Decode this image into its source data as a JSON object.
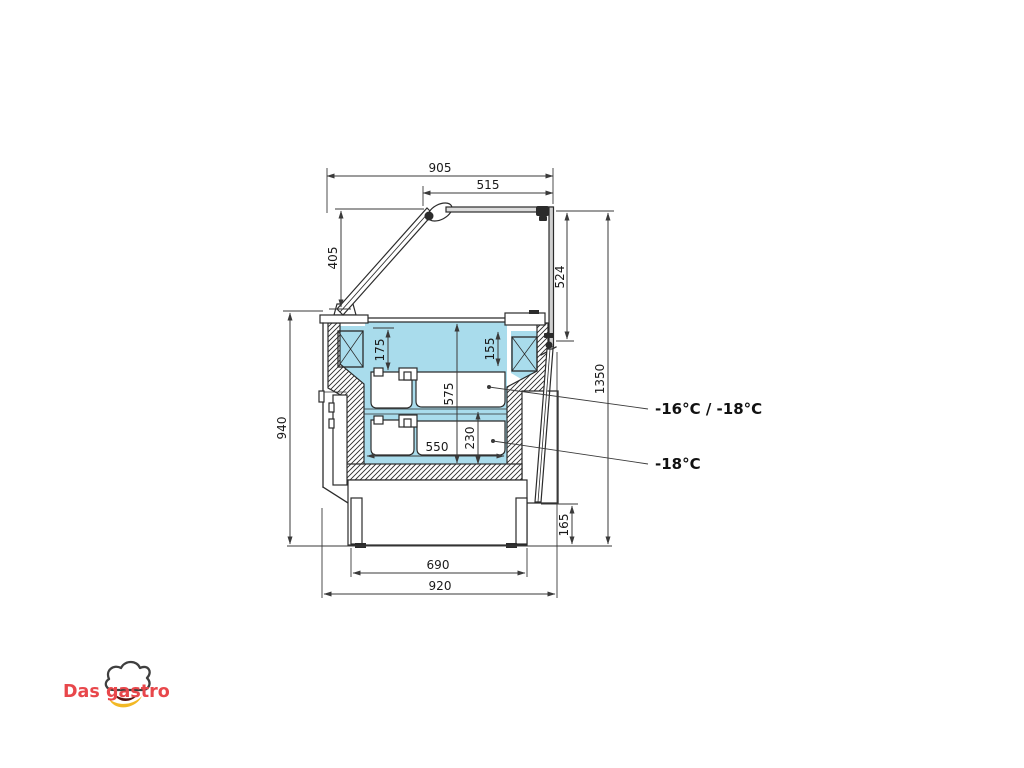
{
  "drawing": {
    "dimensions": {
      "top_width": "905",
      "top_inner_width": "515",
      "front_glass_height": "405",
      "rear_glass_height": "524",
      "total_height": "1350",
      "body_height": "940",
      "well_depth_left": "175",
      "well_depth_right": "155",
      "interior_depth": "575",
      "lower_interior_width": "550",
      "lower_tub_depth": "230",
      "base_width": "690",
      "overall_depth": "920",
      "base_height": "165"
    },
    "annotations": {
      "upper_temp": "-16°C / -18°C",
      "lower_temp": "-18°C"
    }
  },
  "logo": {
    "word1": "Das",
    "word2": "gastro"
  },
  "colors": {
    "interior_fill": "#a9dcec",
    "line": "#2b2b2b",
    "dim_line": "#3a3a3a",
    "logo_red": "#e8474b",
    "logo_gold": "#f2b824",
    "logo_dark": "#3f3f3f"
  }
}
